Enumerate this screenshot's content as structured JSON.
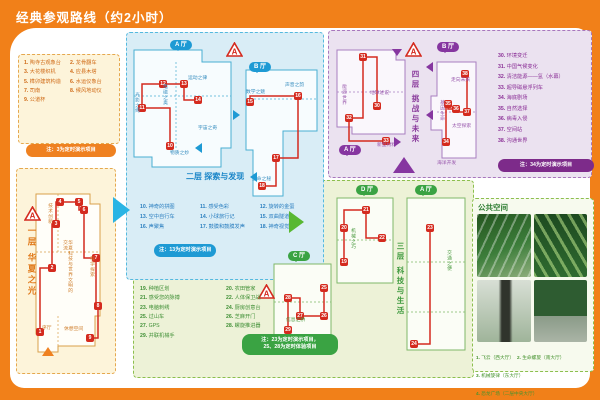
{
  "title": "经典参观路线（约2小时）",
  "marker_letter": "A",
  "colors": {
    "orange": "#f18019",
    "blue": "#1e9ad4",
    "green": "#3aa343",
    "purple": "#8636a0",
    "route": "#d42a1e"
  },
  "markers": [
    {
      "x": 24,
      "y": 206
    },
    {
      "x": 226,
      "y": 42
    },
    {
      "x": 258,
      "y": 284
    },
    {
      "x": 405,
      "y": 42
    }
  ],
  "floors": {
    "f1": {
      "name": "一层  华夏之光",
      "note": "注：3为定时演示项目",
      "legend": [
        {
          "n": "1",
          "label": "陶寺古观象台"
        },
        {
          "n": "2",
          "label": "龙骨翻车"
        },
        {
          "n": "3",
          "label": "大花楼织机"
        },
        {
          "n": "4",
          "label": "应县木塔"
        },
        {
          "n": "5",
          "label": "榫卯建筑构造"
        },
        {
          "n": "6",
          "label": "水运仪象台"
        },
        {
          "n": "7",
          "label": "司南"
        },
        {
          "n": "8",
          "label": "候风地动仪"
        },
        {
          "n": "9",
          "label": "公道杯"
        }
      ],
      "areas": [
        {
          "t": "序厅",
          "x": 42,
          "y": 326
        },
        {
          "t": "技术创新",
          "x": 47,
          "y": 203,
          "v": 1
        },
        {
          "t": "华夏科技与世界文明的交流",
          "x": 62,
          "y": 240,
          "v": 1,
          "h": 58
        },
        {
          "t": "科学探索",
          "x": 89,
          "y": 256,
          "v": 1
        },
        {
          "t": "休憩空间",
          "x": 64,
          "y": 327
        }
      ],
      "routes": [
        {
          "stops": [
            {
              "n": "1",
              "x": 40,
              "y": 332
            },
            {
              "n": "2",
              "x": 52,
              "y": 268
            },
            {
              "n": "3",
              "x": 56,
              "y": 224
            },
            {
              "n": "4",
              "x": 60,
              "y": 202
            },
            {
              "n": "5",
              "x": 79,
              "y": 202
            },
            {
              "n": "6",
              "x": 84,
              "y": 210
            },
            {
              "n": "7",
              "x": 96,
              "y": 258
            },
            {
              "n": "8",
              "x": 98,
              "y": 306
            },
            {
              "n": "9",
              "x": 90,
              "y": 338
            }
          ]
        }
      ]
    },
    "f2": {
      "name": "二层  探索与发现",
      "halls": [
        "A 厅",
        "B 厅"
      ],
      "note": "注：13为定时演示项目",
      "legend": [
        {
          "n": "10",
          "label": "神奇的拼图"
        },
        {
          "n": "11",
          "label": "感受色彩"
        },
        {
          "n": "12",
          "label": "旋转的金蛋"
        },
        {
          "n": "13",
          "label": "空中自行车"
        },
        {
          "n": "14",
          "label": "小球旅行记"
        },
        {
          "n": "15",
          "label": "双曲隧道"
        },
        {
          "n": "16",
          "label": "声聚焦"
        },
        {
          "n": "17",
          "label": "鼓膜和鼓膜发声"
        },
        {
          "n": "18",
          "label": "神奇视觉"
        }
      ],
      "areas": [
        {
          "t": "光影之绚",
          "x": 134,
          "y": 92,
          "v": 1
        },
        {
          "t": "电磁之奥",
          "x": 162,
          "y": 84,
          "v": 1
        },
        {
          "t": "运动之律",
          "x": 188,
          "y": 76
        },
        {
          "t": "宇宙之奇",
          "x": 198,
          "y": 126
        },
        {
          "t": "物质之妙",
          "x": 170,
          "y": 151
        },
        {
          "t": "数学之魅",
          "x": 246,
          "y": 90
        },
        {
          "t": "声音之韵",
          "x": 285,
          "y": 83
        },
        {
          "t": "生命之秘",
          "x": 252,
          "y": 177
        }
      ],
      "routes": [
        {
          "stops": [
            {
              "n": "10",
              "x": 170,
              "y": 146
            },
            {
              "n": "11",
              "x": 142,
              "y": 108
            },
            {
              "n": "12",
              "x": 163,
              "y": 84
            },
            {
              "n": "13",
              "x": 184,
              "y": 84
            },
            {
              "n": "14",
              "x": 198,
              "y": 100
            }
          ]
        },
        {
          "stops": [
            {
              "n": "15",
              "x": 250,
              "y": 102
            },
            {
              "n": "16",
              "x": 298,
              "y": 96
            },
            {
              "n": "17",
              "x": 276,
              "y": 158
            },
            {
              "n": "18",
              "x": 262,
              "y": 186
            }
          ]
        }
      ]
    },
    "f3": {
      "name": "三层  科技与生活",
      "halls": [
        "D 厅",
        "A 厅",
        "C 厅"
      ],
      "note_lines": [
        "注：23为定时演示项目，",
        "25、28为定时体验项目"
      ],
      "legend": [
        {
          "n": "19",
          "label": "种植区划"
        },
        {
          "n": "20",
          "label": "农田管家"
        },
        {
          "n": "21",
          "label": "感受您的脉搏"
        },
        {
          "n": "22",
          "label": "人体保卫战"
        },
        {
          "n": "23",
          "label": "电脑刺绣"
        },
        {
          "n": "24",
          "label": "厨房创意台"
        },
        {
          "n": "25",
          "label": "过山车"
        },
        {
          "n": "26",
          "label": "芝麻开门"
        },
        {
          "n": "27",
          "label": "GPS"
        },
        {
          "n": "28",
          "label": "螺旋推进器"
        },
        {
          "n": "29",
          "label": "并联机械手"
        }
      ],
      "areas": [
        {
          "t": "机械之巧",
          "x": 350,
          "y": 228,
          "v": 1
        },
        {
          "t": "交通之便",
          "x": 446,
          "y": 250,
          "v": 1
        },
        {
          "t": "信息之桥",
          "x": 286,
          "y": 318
        }
      ],
      "routes": [
        {
          "stops": [
            {
              "n": "19",
              "x": 344,
              "y": 262
            },
            {
              "n": "20",
              "x": 344,
              "y": 228
            },
            {
              "n": "21",
              "x": 366,
              "y": 210
            },
            {
              "n": "22",
              "x": 382,
              "y": 238
            }
          ]
        },
        {
          "stops": [
            {
              "n": "23",
              "x": 430,
              "y": 228
            },
            {
              "n": "24",
              "x": 414,
              "y": 344
            }
          ]
        },
        {
          "stops": [
            {
              "n": "25",
              "x": 324,
              "y": 288
            },
            {
              "n": "26",
              "x": 324,
              "y": 316
            },
            {
              "n": "27",
              "x": 300,
              "y": 316
            },
            {
              "n": "28",
              "x": 288,
              "y": 298
            },
            {
              "n": "29",
              "x": 288,
              "y": 330
            }
          ]
        }
      ]
    },
    "f4": {
      "name": "四层  挑战与未来",
      "halls": [
        "A 厅",
        "B 厅"
      ],
      "note": "注：34为定时演示项目",
      "legend": [
        {
          "n": "30",
          "label": "环境变迁"
        },
        {
          "n": "31",
          "label": "中国气候变化"
        },
        {
          "n": "32",
          "label": "清洁能源——氢（水幕）"
        },
        {
          "n": "33",
          "label": "超导磁悬浮列车"
        },
        {
          "n": "34",
          "label": "海底剧场"
        },
        {
          "n": "35",
          "label": "自然选择"
        },
        {
          "n": "36",
          "label": "病毒入侵"
        },
        {
          "n": "37",
          "label": "空间站"
        },
        {
          "n": "38",
          "label": "沟通世界"
        }
      ],
      "areas": [
        {
          "t": "能源世界",
          "x": 341,
          "y": 84,
          "v": 1
        },
        {
          "t": "地球述说",
          "x": 370,
          "y": 91
        },
        {
          "t": "新型材料",
          "x": 377,
          "y": 143
        },
        {
          "t": "走向未来",
          "x": 451,
          "y": 78
        },
        {
          "t": "基因生命",
          "x": 439,
          "y": 100,
          "v": 1
        },
        {
          "t": "太空探索",
          "x": 452,
          "y": 124
        },
        {
          "t": "海洋开发",
          "x": 437,
          "y": 161
        }
      ],
      "routes": [
        {
          "stops": [
            {
              "n": "30",
              "x": 377,
              "y": 106
            },
            {
              "n": "31",
              "x": 363,
              "y": 57
            },
            {
              "n": "32",
              "x": 349,
              "y": 118
            },
            {
              "n": "33",
              "x": 386,
              "y": 141
            }
          ]
        },
        {
          "stops": [
            {
              "n": "34",
              "x": 446,
              "y": 142
            },
            {
              "n": "35",
              "x": 448,
              "y": 104
            },
            {
              "n": "36",
              "x": 456,
              "y": 109
            },
            {
              "n": "37",
              "x": 467,
              "y": 112
            },
            {
              "n": "38",
              "x": 465,
              "y": 74
            }
          ]
        }
      ]
    }
  },
  "public_space": {
    "title": "公共空间",
    "items": [
      {
        "n": "1",
        "label": "飞云（西大厅）"
      },
      {
        "n": "2",
        "label": "生命螺旋（南大厅）"
      },
      {
        "n": "3",
        "label": "机械旋律（东大厅）"
      },
      {
        "n": "4",
        "label": "恐龙广场（二层中央大厅）"
      }
    ]
  }
}
